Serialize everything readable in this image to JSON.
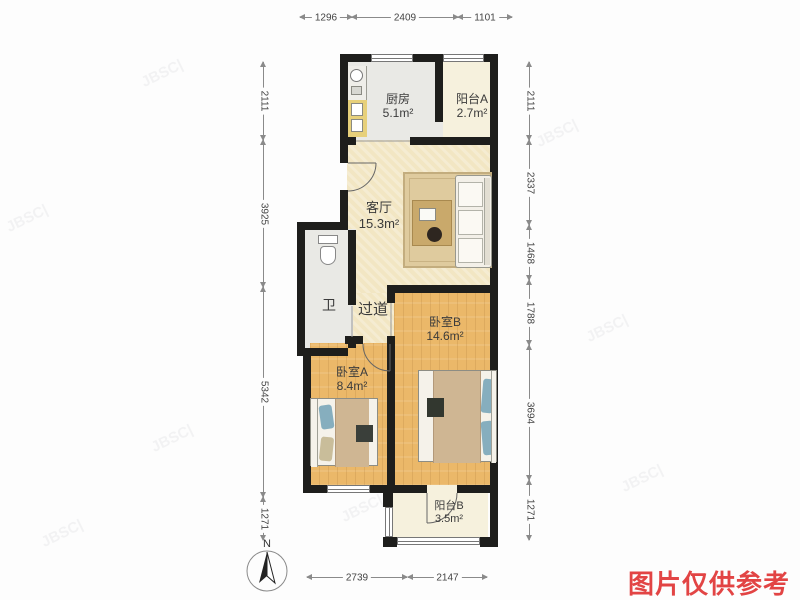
{
  "plan": {
    "rooms": {
      "kitchen": {
        "name": "厨房",
        "area": "5.1m²"
      },
      "balcony_a": {
        "name": "阳台A",
        "area": "2.7m²"
      },
      "living_room": {
        "name": "客厅",
        "area": "15.3m²"
      },
      "bathroom": {
        "name": "卫"
      },
      "corridor": {
        "name": "过道"
      },
      "bedroom_b": {
        "name": "卧室B",
        "area": "14.6m²"
      },
      "bedroom_a": {
        "name": "卧室A",
        "area": "8.4m²"
      },
      "balcony_b": {
        "name": "阳台B",
        "area": "3.5m²"
      }
    },
    "dimensions": {
      "top": [
        "1296",
        "2409",
        "1101"
      ],
      "left": [
        "2111",
        "3925",
        "5342",
        "1271"
      ],
      "right": [
        "2111",
        "2337",
        "1468",
        "1788",
        "3694",
        "1271"
      ],
      "bottom": [
        "2739",
        "2147"
      ]
    },
    "compass": {
      "label": "N"
    }
  },
  "disclaimer": {
    "text": "图片仅供参考",
    "color": "#e24444"
  },
  "watermark": {
    "text": "JBSC|"
  },
  "colors": {
    "wall": "#1e1e1c",
    "wood_floor": "#ebb869",
    "cream_floor": "#f2e6c3",
    "gray_floor": "#e9e9e5",
    "pale_floor": "#f6f1dd",
    "pillow": "#86aebe",
    "blanket": "#cfb693",
    "rug": "#dfcb9e"
  }
}
